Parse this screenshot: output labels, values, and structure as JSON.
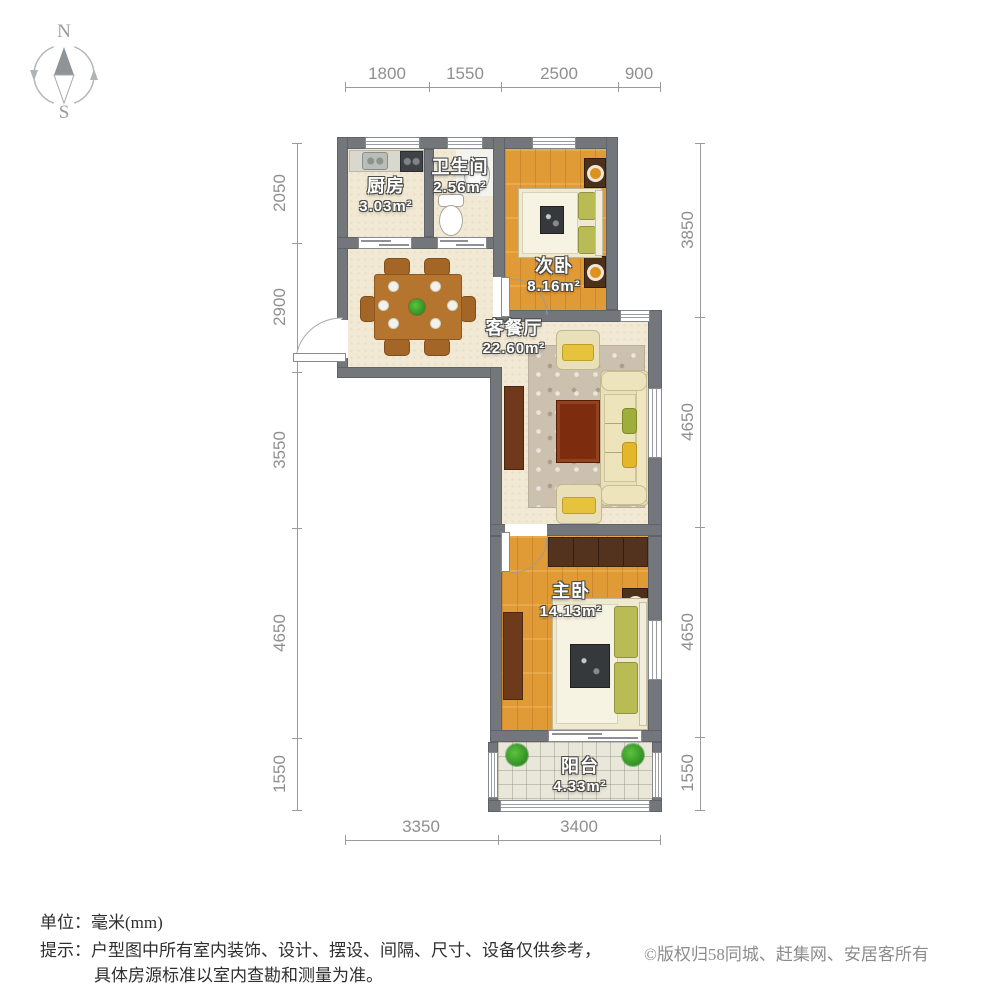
{
  "compass": {
    "north": "N",
    "south": "S"
  },
  "rooms": [
    {
      "name": "厨房",
      "area": "3.03m²"
    },
    {
      "name": "卫生间",
      "area": "2.56m²"
    },
    {
      "name": "次卧",
      "area": "8.16m²"
    },
    {
      "name": "客餐厅",
      "area": "22.60m²"
    },
    {
      "name": "主卧",
      "area": "14.13m²"
    },
    {
      "name": "阳台",
      "area": "4.33m²"
    }
  ],
  "dimensions": {
    "top": [
      "1800",
      "1550",
      "2500",
      "900"
    ],
    "bottom": [
      "3350",
      "3400"
    ],
    "left": [
      "2050",
      "2900",
      "3550",
      "4650",
      "1550"
    ],
    "right": [
      "3850",
      "4650",
      "4650",
      "1550"
    ]
  },
  "footer": {
    "unit_label": "单位：",
    "unit_value": "毫米(mm)",
    "tip_label": "提示：",
    "tip_line1": "户型图中所有室内装饰、设计、摆设、间隔、尺寸、设备仅供参考，",
    "tip_line2": "具体房源标准以室内查勘和测量为准。",
    "copyright": "©版权归58同城、赶集网、安居客所有"
  },
  "colors": {
    "wall": "#73767b",
    "floor_light": "#f2e9d5",
    "floor_wood": "#e19b36",
    "floor_tile": "#e9e7d9",
    "furniture_dark": "#5a351e",
    "table_wood": "#b5752f",
    "accent_yellow": "#e4b72a",
    "accent_green": "#9fae3a",
    "plant_green": "#3aa32c",
    "dimension_text": "#8f8f8f"
  }
}
